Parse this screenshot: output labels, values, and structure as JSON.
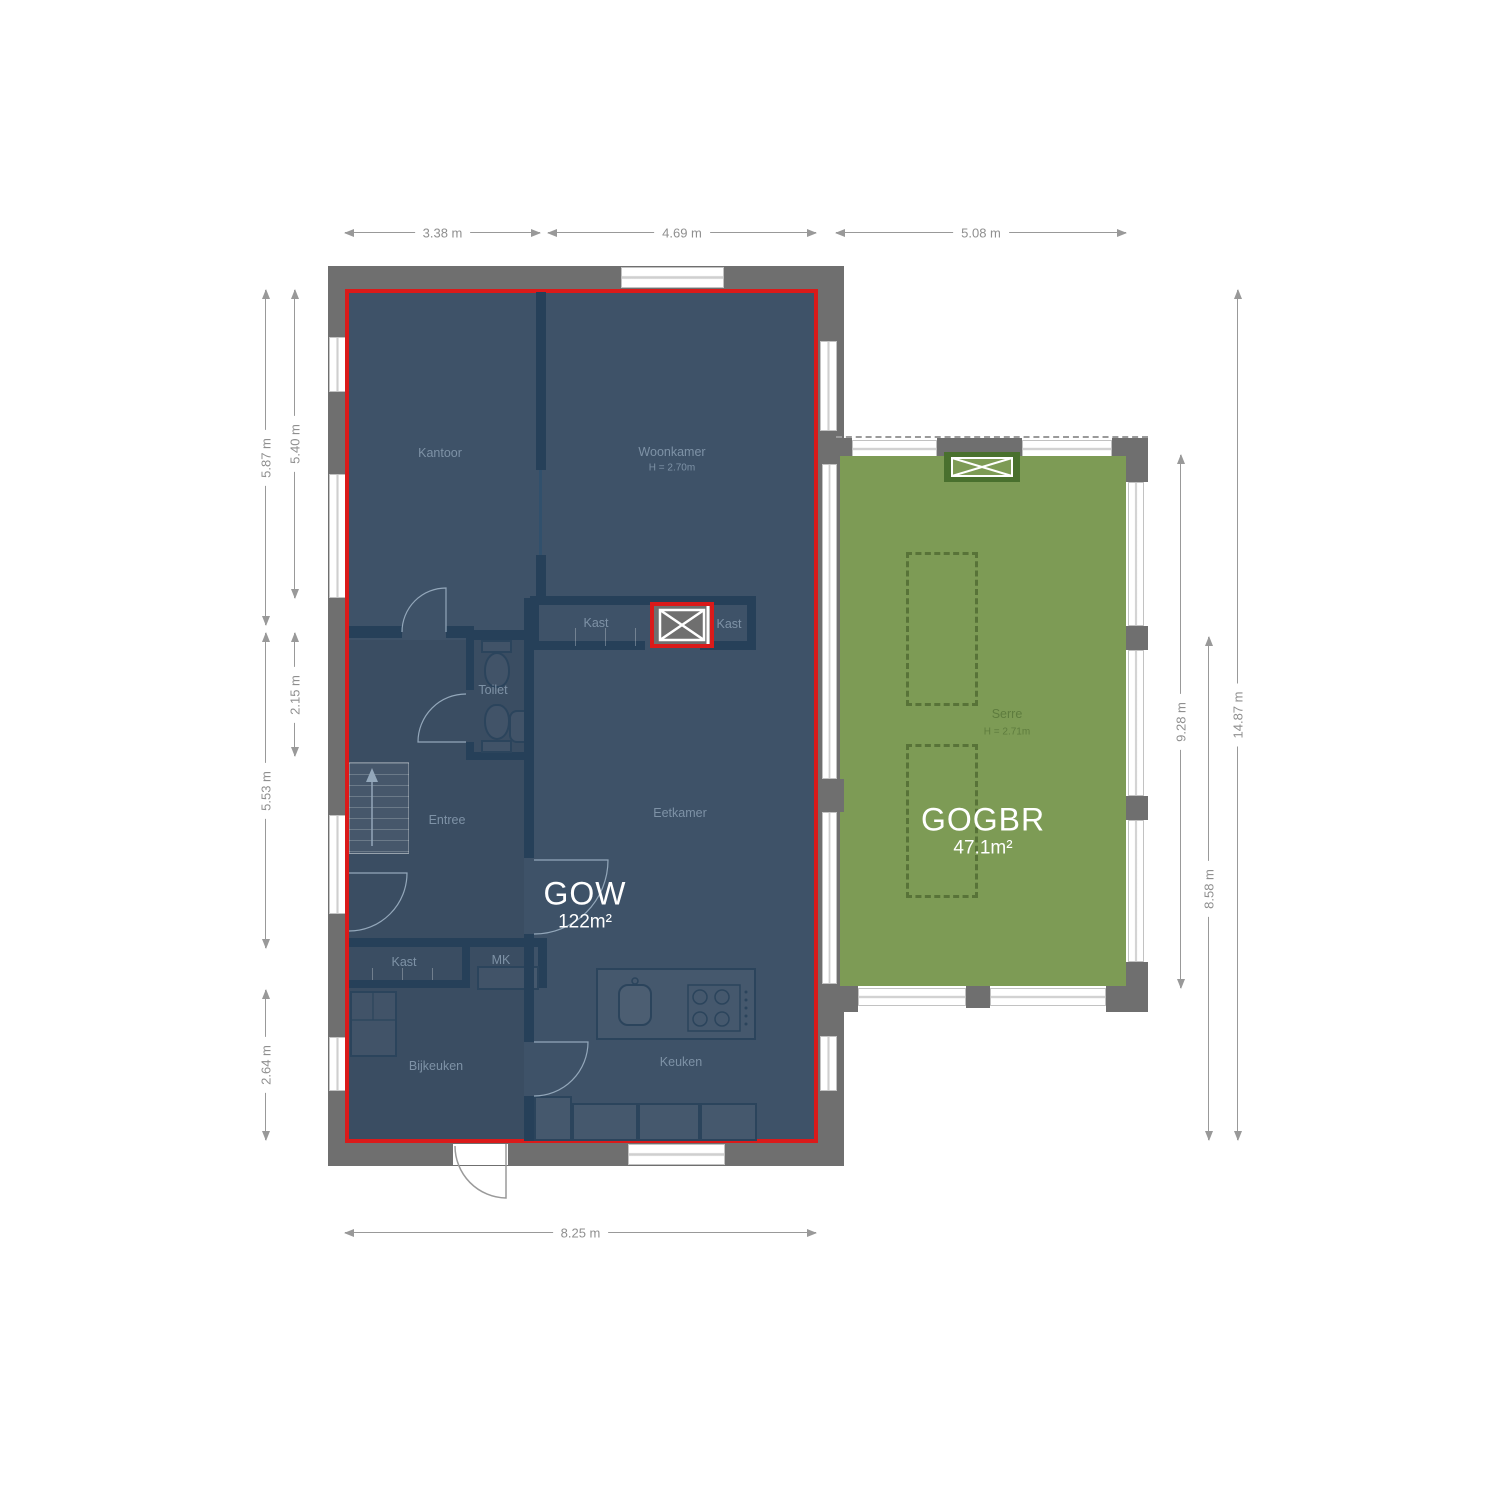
{
  "zones": {
    "gow": {
      "name": "GOW",
      "area": "122m²"
    },
    "gogbr": {
      "name": "GOGBR",
      "area": "47.1m²"
    }
  },
  "rooms": {
    "kantoor": "Kantoor",
    "woonkamer": "Woonkamer",
    "woonkamer_h": "H = 2.70m",
    "kast_mid_left": "Kast",
    "kast_mid_right": "Kast",
    "toilet": "Toilet",
    "entree": "Entree",
    "eetkamer": "Eetkamer",
    "kast_bottom": "Kast",
    "mk": "MK",
    "bijkeuken": "Bijkeuken",
    "keuken": "Keuken",
    "serre": "Serre",
    "serre_h": "H = 2.71m"
  },
  "dimensions": {
    "top": [
      "3.38 m",
      "4.69 m",
      "5.08 m"
    ],
    "left": [
      "5.87 m",
      "5.40 m",
      "2.15 m",
      "5.53 m",
      "2.64 m"
    ],
    "right": [
      "9.28 m",
      "8.58 m",
      "14.87 m"
    ],
    "bottom": [
      "8.25 m"
    ]
  },
  "colors": {
    "highlight_red": "#da1a1a",
    "gow_fill": "#3e5268",
    "gogbr_fill": "#7d9b55",
    "wall_gray": "#6f6f6f",
    "interior_wall": "#264059",
    "dimension_gray": "#8f8f8f"
  }
}
